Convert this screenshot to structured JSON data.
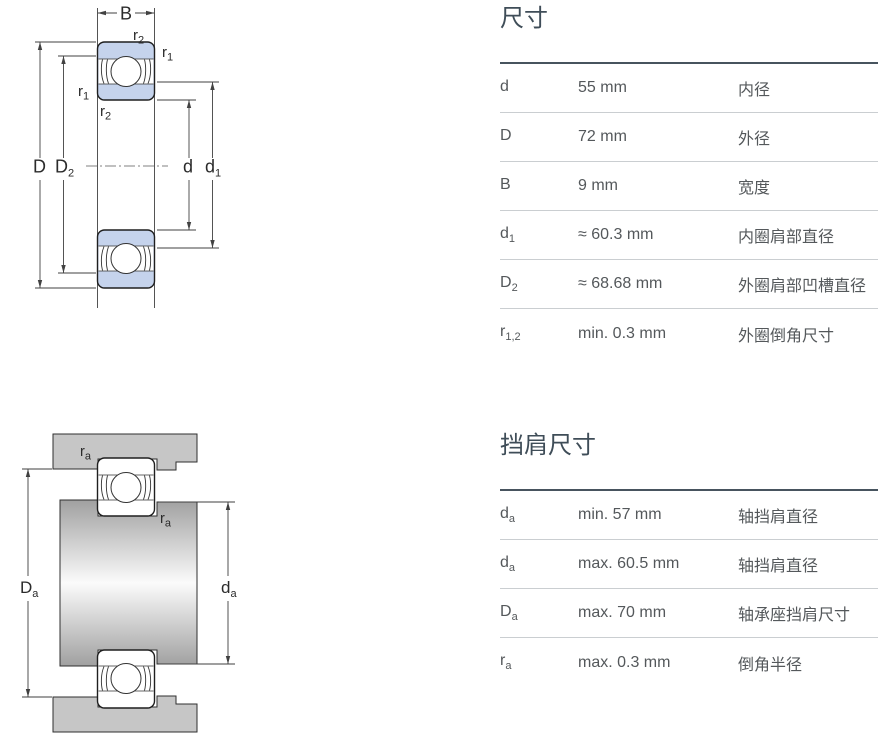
{
  "colors": {
    "bearing_blue": "#c5d3ec",
    "housing_gray": "#c6c6c6",
    "outline": "#1f1f1f",
    "dimension_line": "#424242",
    "title_text": "#3f4d58",
    "table_text": "#54585b",
    "table_top_border": "#47545e",
    "table_divider": "#caced1"
  },
  "figures": {
    "top": {
      "labels": {
        "B": {
          "main": "B"
        },
        "r2_top": {
          "main": "r",
          "sub": "2"
        },
        "r1_right": {
          "main": "r",
          "sub": "1"
        },
        "r1_left": {
          "main": "r",
          "sub": "1"
        },
        "r2_bottom": {
          "main": "r",
          "sub": "2"
        },
        "D": {
          "main": "D"
        },
        "D2": {
          "main": "D",
          "sub": "2"
        },
        "d": {
          "main": "d"
        },
        "d1": {
          "main": "d",
          "sub": "1"
        }
      }
    },
    "bottom": {
      "labels": {
        "ra_top": {
          "main": "r",
          "sub": "a"
        },
        "ra_right": {
          "main": "r",
          "sub": "a"
        },
        "Da": {
          "main": "D",
          "sub": "a"
        },
        "da": {
          "main": "d",
          "sub": "a"
        }
      }
    }
  },
  "tables": [
    {
      "title": "尺寸",
      "rows": [
        {
          "symbol": "d",
          "sub": "",
          "value": "55 mm",
          "description": "内径"
        },
        {
          "symbol": "D",
          "sub": "",
          "value": "72 mm",
          "description": "外径"
        },
        {
          "symbol": "B",
          "sub": "",
          "value": "9 mm",
          "description": "宽度"
        },
        {
          "symbol": "d",
          "sub": "1",
          "value": "≈ 60.3 mm",
          "description": "内圈肩部直径"
        },
        {
          "symbol": "D",
          "sub": "2",
          "value": "≈ 68.68 mm",
          "description": "外圈肩部凹槽直径"
        },
        {
          "symbol": "r",
          "sub": "1,2",
          "value": "min. 0.3 mm",
          "description": "外圈倒角尺寸"
        }
      ]
    },
    {
      "title": "挡肩尺寸",
      "rows": [
        {
          "symbol": "d",
          "sub": "a",
          "value": "min. 57 mm",
          "description": "轴挡肩直径"
        },
        {
          "symbol": "d",
          "sub": "a",
          "value": "max. 60.5 mm",
          "description": "轴挡肩直径"
        },
        {
          "symbol": "D",
          "sub": "a",
          "value": "max. 70 mm",
          "description": "轴承座挡肩尺寸"
        },
        {
          "symbol": "r",
          "sub": "a",
          "value": "max. 0.3 mm",
          "description": "倒角半径"
        }
      ]
    }
  ]
}
